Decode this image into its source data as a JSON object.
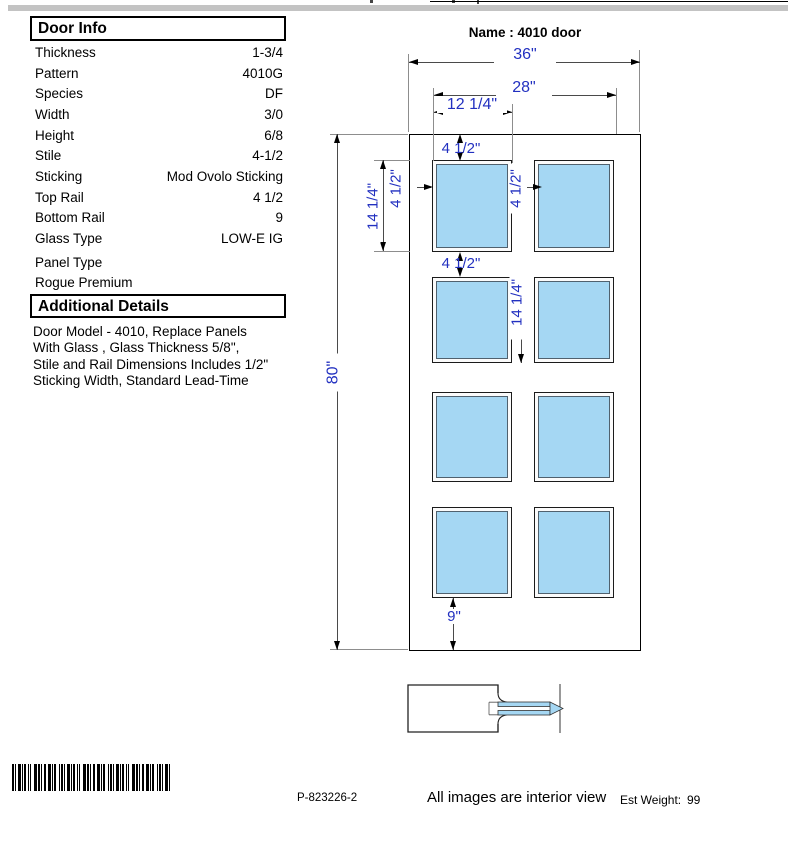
{
  "door_info": {
    "title": "Door Info",
    "rows": [
      {
        "label": "Thickness",
        "value": "1-3/4"
      },
      {
        "label": "Pattern",
        "value": "4010G"
      },
      {
        "label": "Species",
        "value": "DF"
      },
      {
        "label": "Width",
        "value": "3/0"
      },
      {
        "label": "Height",
        "value": "6/8"
      },
      {
        "label": "Stile",
        "value": "4-1/2"
      },
      {
        "label": "Sticking",
        "value": "Mod Ovolo Sticking"
      },
      {
        "label": "Top Rail",
        "value": "4 1/2"
      },
      {
        "label": "Bottom Rail",
        "value": "9"
      },
      {
        "label": "Glass Type",
        "value": "LOW-E IG"
      },
      {
        "label": "Panel Type",
        "value": ""
      }
    ],
    "panel_type_value": "Rogue Premium"
  },
  "additional_details": {
    "title": "Additional Details",
    "lines": [
      "Door Model - 4010, Replace Panels",
      "With Glass , Glass Thickness  5/8\",",
      "Stile and Rail Dimensions Includes 1/2\"",
      "Sticking Width, Standard Lead-Time"
    ]
  },
  "drawing": {
    "name_label": "Name : 4010 door",
    "dims": {
      "overall_width": "36\"",
      "glass_span": "28\"",
      "lite_width": "12 1/4\"",
      "top_rail": "4 1/2\"",
      "stile": "4 1/2\"",
      "mullion": "4 1/2\"",
      "lite_height": "14 1/4\"",
      "cross_rail": "4 1/2\"",
      "lite_height_2": "14 1/4\"",
      "overall_height": "80\"",
      "bottom_rail": "9\""
    }
  },
  "footer": {
    "part_number": "P-823226-2",
    "note": "All images are interior view",
    "est_weight_label": "Est Weight:",
    "est_weight_value": "99"
  },
  "colors": {
    "dimension_text": "#2230c0",
    "glass": "#a5d7f3"
  }
}
